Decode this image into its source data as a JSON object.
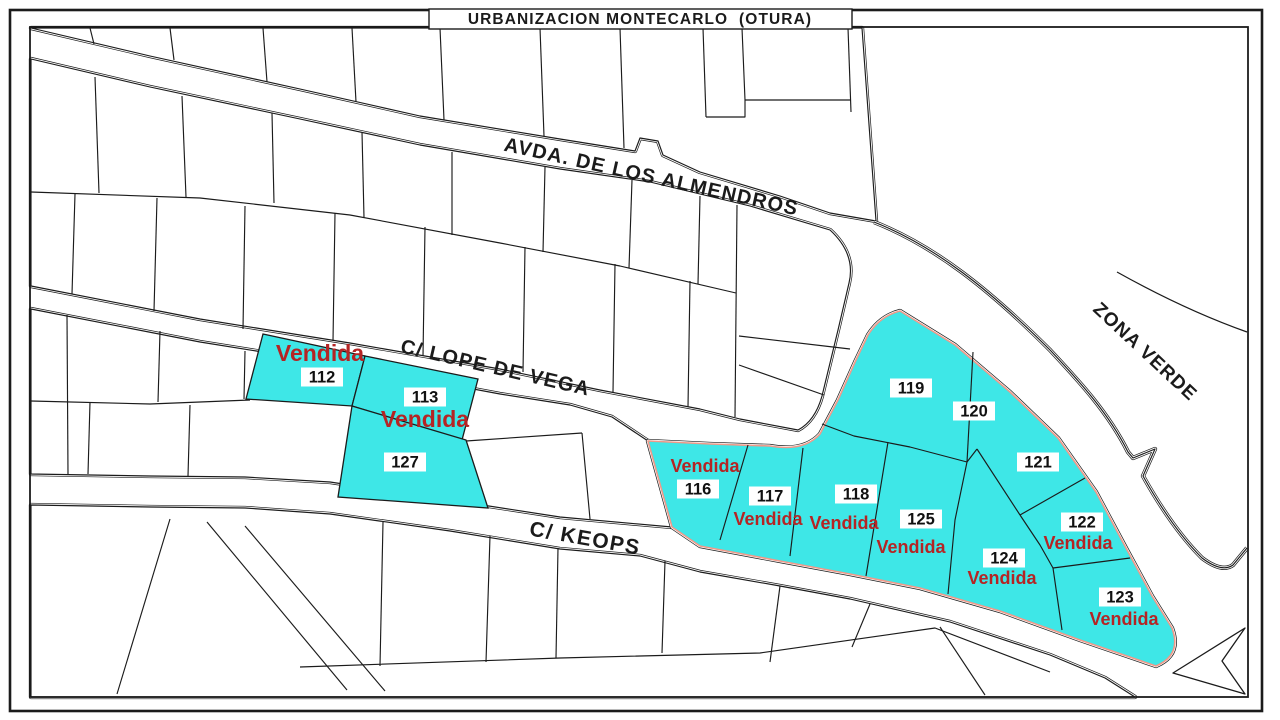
{
  "title": "URBANIZACION MONTECARLO  (OTURA)",
  "sold_label": "Vendida",
  "colors": {
    "background": "#ffffff",
    "line": "#1b1b1b",
    "plot_sold_fill": "#3EE7E7",
    "sold_text_red": "#B52424",
    "cluster_outline_red": "#F09A8A"
  },
  "streets": [
    {
      "name": "AVDA. DE LOS ALMENDROS",
      "x": 650,
      "y": 183,
      "angle": 12.5,
      "size": 20,
      "spacing": 1.2
    },
    {
      "name": "C/ LOPE DE VEGA",
      "x": 494,
      "y": 374,
      "angle": 13,
      "size": 20,
      "spacing": 1.2
    },
    {
      "name": "C/ KEOPS",
      "x": 584,
      "y": 545,
      "angle": 10,
      "size": 21,
      "spacing": 1.5
    },
    {
      "name": "ZONA VERDE",
      "x": 1141,
      "y": 356,
      "angle": 43,
      "size": 19,
      "spacing": 1
    }
  ],
  "plots": [
    {
      "number": "112",
      "sold": true,
      "label": {
        "x": 322,
        "y": 377
      },
      "vendida": {
        "x": 320,
        "y": 353,
        "size": 23
      }
    },
    {
      "number": "113",
      "sold": true,
      "label": {
        "x": 425,
        "y": 397
      },
      "vendida": {
        "x": 425,
        "y": 419,
        "size": 23
      }
    },
    {
      "number": "127",
      "sold": true,
      "label": {
        "x": 405,
        "y": 462
      },
      "vendida": null
    },
    {
      "number": "116",
      "sold": true,
      "label": {
        "x": 698,
        "y": 489
      },
      "vendida": {
        "x": 705,
        "y": 466,
        "size": 18
      }
    },
    {
      "number": "117",
      "sold": true,
      "label": {
        "x": 770,
        "y": 496
      },
      "vendida": {
        "x": 768,
        "y": 519,
        "size": 18
      }
    },
    {
      "number": "118",
      "sold": true,
      "label": {
        "x": 856,
        "y": 494
      },
      "vendida": {
        "x": 844,
        "y": 523,
        "size": 18
      }
    },
    {
      "number": "125",
      "sold": true,
      "label": {
        "x": 921,
        "y": 519
      },
      "vendida": {
        "x": 911,
        "y": 547,
        "size": 18
      }
    },
    {
      "number": "119",
      "sold": true,
      "label": {
        "x": 911,
        "y": 388
      },
      "vendida": null
    },
    {
      "number": "120",
      "sold": true,
      "label": {
        "x": 974,
        "y": 411
      },
      "vendida": null
    },
    {
      "number": "121",
      "sold": true,
      "label": {
        "x": 1038,
        "y": 462
      },
      "vendida": null
    },
    {
      "number": "122",
      "sold": true,
      "label": {
        "x": 1082,
        "y": 522
      },
      "vendida": {
        "x": 1078,
        "y": 543,
        "size": 18
      }
    },
    {
      "number": "124",
      "sold": true,
      "label": {
        "x": 1004,
        "y": 558
      },
      "vendida": {
        "x": 1002,
        "y": 578,
        "size": 18
      }
    },
    {
      "number": "123",
      "sold": true,
      "label": {
        "x": 1120,
        "y": 597
      },
      "vendida": {
        "x": 1124,
        "y": 619,
        "size": 18
      }
    }
  ]
}
